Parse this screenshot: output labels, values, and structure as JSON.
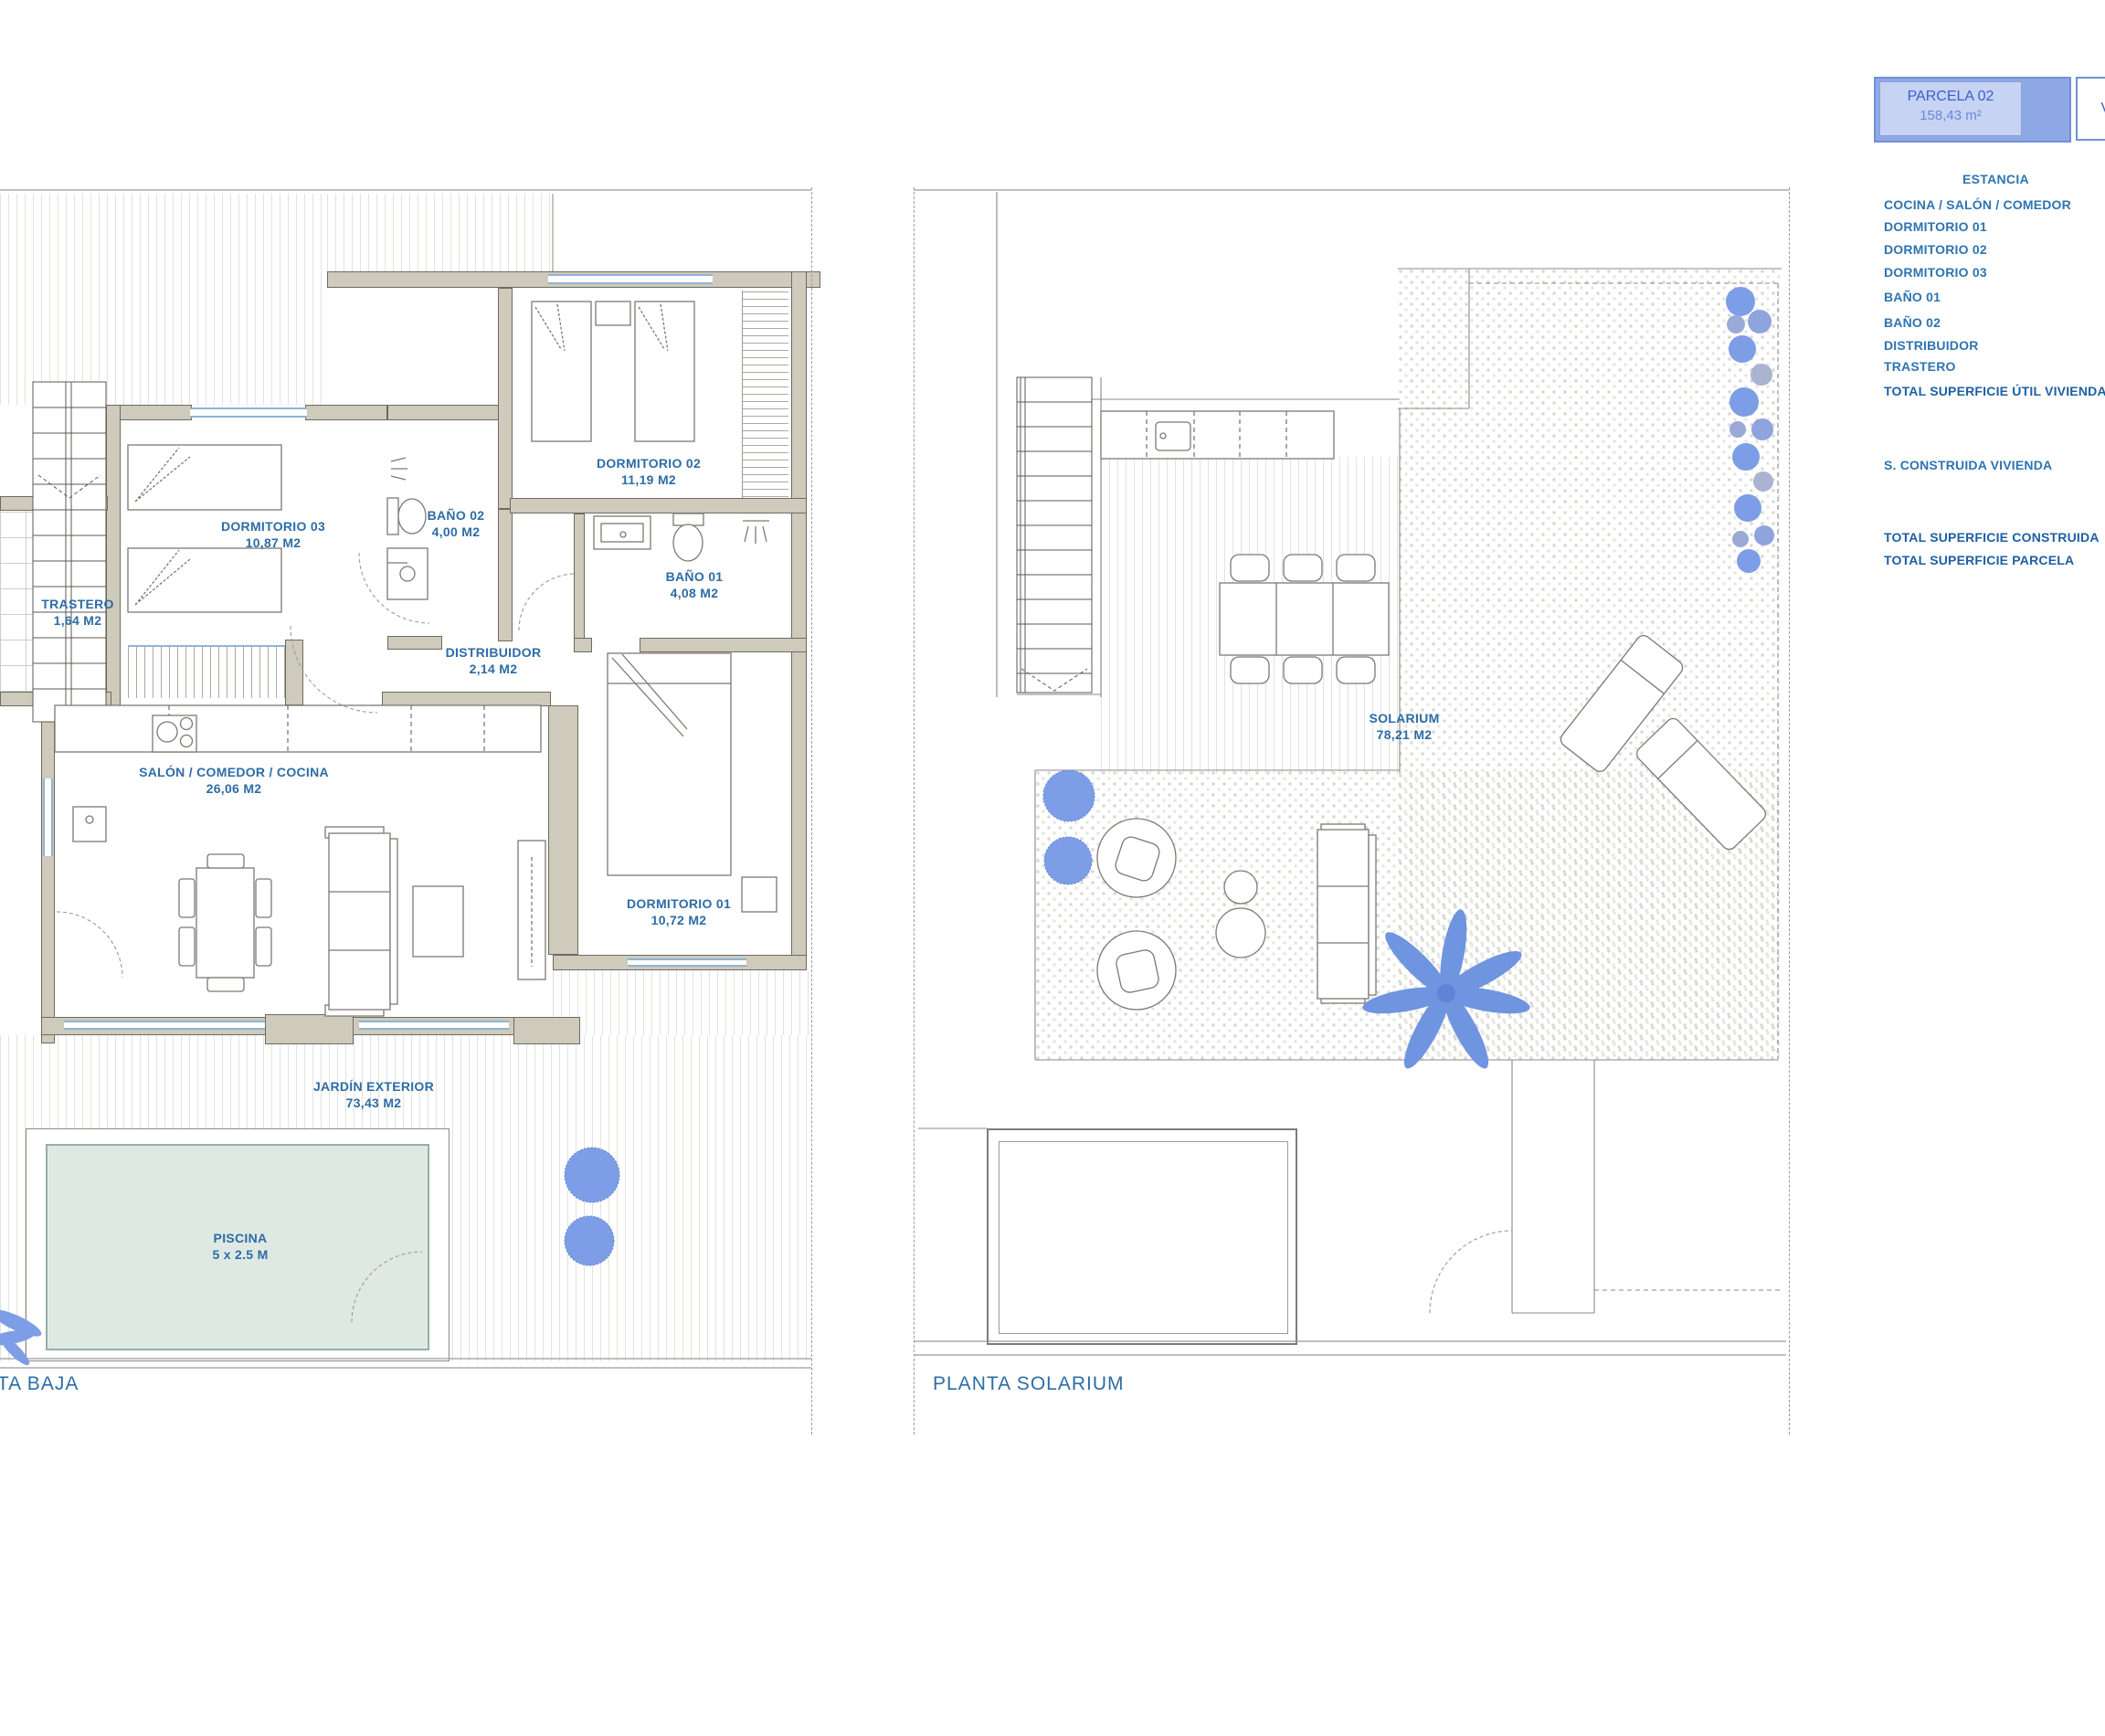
{
  "legend": {
    "parcela": {
      "title": "PARCELA 02",
      "area": "158,43 m²"
    },
    "side_box": "V",
    "estancia_header": "ESTANCIA",
    "rooms": [
      "COCINA / SALÓN / COMEDOR",
      "DORMITORIO 01",
      "DORMITORIO 02",
      "DORMITORIO 03",
      "BAÑO 01",
      "BAÑO 02",
      "DISTRIBUIDOR",
      "TRASTERO"
    ],
    "total_util_label": "TOTAL SUPERFICIE ÚTIL VIVIENDA",
    "s_construida_label": "S. CONSTRUIDA VIVIENDA",
    "total_construida_label": "TOTAL SUPERFICIE CONSTRUIDA",
    "total_parcela_label": "TOTAL SUPERFICIE PARCELA"
  },
  "planta_baja": {
    "title": "PLANTA BAJA",
    "rooms": {
      "trastero": {
        "name": "TRASTERO",
        "area": "1,64 M2"
      },
      "dormitorio03": {
        "name": "DORMITORIO 03",
        "area": "10,87 M2"
      },
      "bano02": {
        "name": "BAÑO 02",
        "area": "4,00 M2"
      },
      "dormitorio02": {
        "name": "DORMITORIO 02",
        "area": "11,19 M2"
      },
      "bano01": {
        "name": "BAÑO 01",
        "area": "4,08 M2"
      },
      "distribuidor": {
        "name": "DISTRIBUIDOR",
        "area": "2,14 M2"
      },
      "salon": {
        "name": "SALÓN / COMEDOR / COCINA",
        "area": "26,06 M2"
      },
      "dormitorio01": {
        "name": "DORMITORIO 01",
        "area": "10,72 M2"
      },
      "jardin": {
        "name": "JARDÍN EXTERIOR",
        "area": "73,43 M2"
      },
      "piscina": {
        "name": "PISCINA",
        "area": "5 x 2.5 M"
      }
    }
  },
  "planta_solarium": {
    "title": "PLANTA SOLARIUM",
    "rooms": {
      "solarium": {
        "name": "SOLARIUM",
        "area": "78,21 M2"
      }
    }
  },
  "colors": {
    "label_text": "#2d6ca6",
    "legend_text": "#2e74b0",
    "accent_blue": "#7d9de6",
    "wall_beige": "#cecabc",
    "pool_fill": "#dfe9e4"
  }
}
